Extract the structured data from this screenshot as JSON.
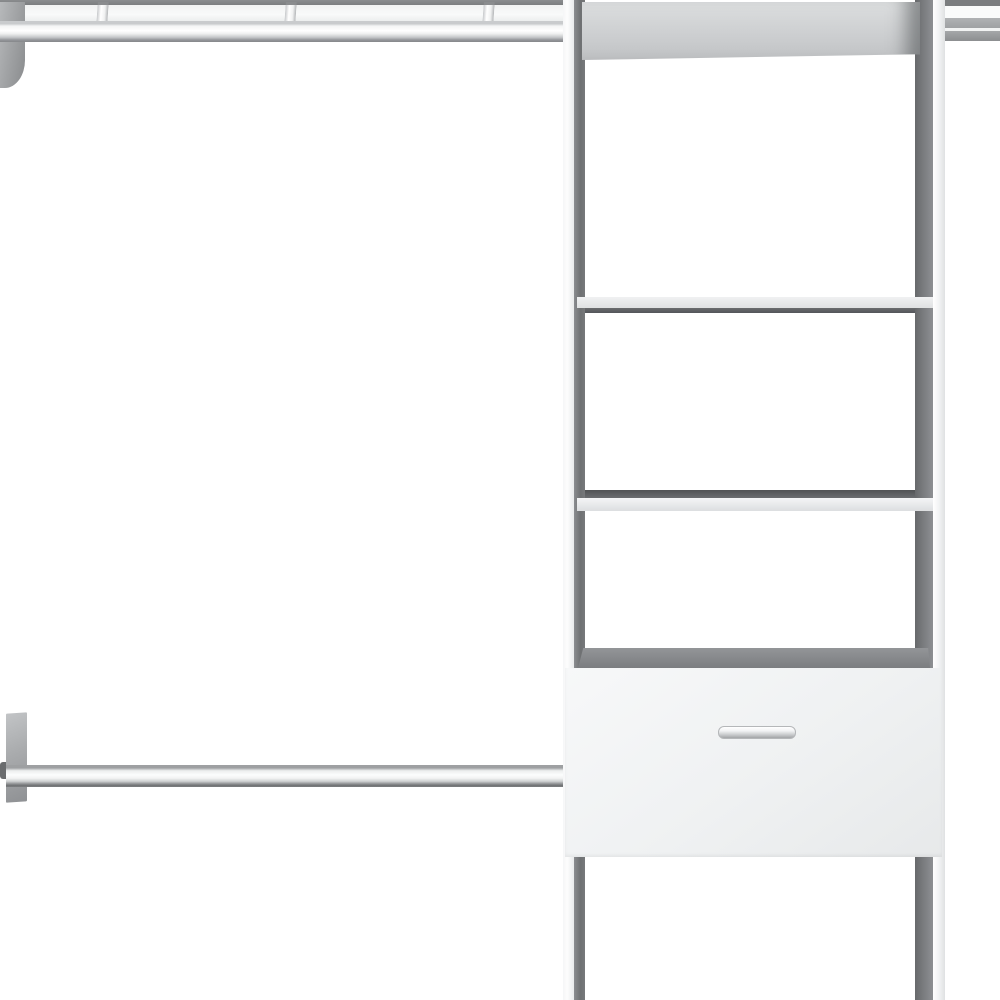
{
  "scene": {
    "type": "product-photo",
    "subject": "White closet organizer system: central shelf tower with two shelves and one drawer with a metal bar handle, a top shelf with hanger rail and three sliding clips, and a lower wall-mounted hanging rod",
    "background_color": "#ffffff"
  },
  "objects": {
    "top_rail": {
      "name": "top shelf with hanger rail",
      "clip_count": 3
    },
    "tower": {
      "name": "shelf tower",
      "shelf_count": 2,
      "drawer": {
        "name": "drawer",
        "handle": "metal-bar-handle"
      }
    },
    "lower_rod": {
      "name": "hanging rod",
      "mount": "wall plate"
    }
  },
  "palette": {
    "background": "#ffffff",
    "panel-light": "#eff1f2",
    "panel-gray": "#cfd1d3",
    "shadow-gray": "#76787a",
    "dark-line": "#54565a",
    "metal-light": "#f4f5f5",
    "metal-mid": "#a8aaac",
    "metal-dark": "#717375"
  }
}
